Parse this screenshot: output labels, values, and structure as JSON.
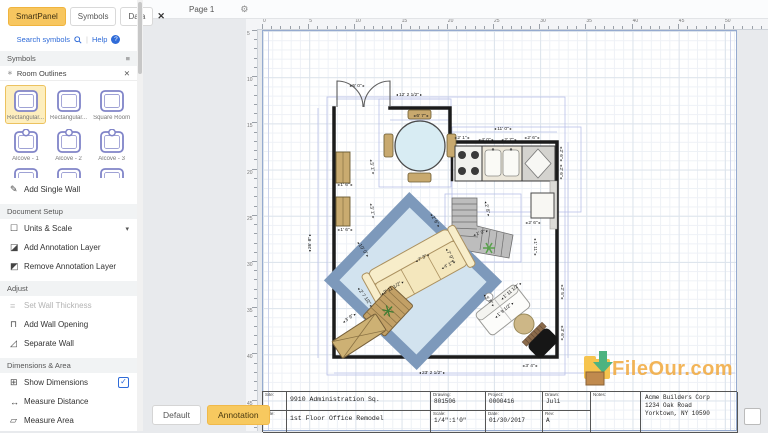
{
  "sidebar": {
    "tabs": [
      {
        "label": "SmartPanel",
        "active": true
      },
      {
        "label": "Symbols",
        "active": false
      },
      {
        "label": "Data",
        "active": false
      }
    ],
    "close_icon": "✕",
    "search": {
      "label": "Search symbols",
      "help": "Help"
    },
    "panel_header": "Symbols",
    "group_header": "Room Outlines",
    "symbols": [
      {
        "label": "Rectangular...",
        "selected": true
      },
      {
        "label": "Rectangular...",
        "selected": false
      },
      {
        "label": "Square Room",
        "selected": false
      },
      {
        "label": "Alcove - 1",
        "selected": false
      },
      {
        "label": "Alcove - 2",
        "selected": false
      },
      {
        "label": "Alcove - 3",
        "selected": false
      }
    ],
    "sections": [
      {
        "title": null,
        "items": [
          {
            "label": "Add Single Wall",
            "icon": "pencil"
          }
        ]
      },
      {
        "title": "Document Setup",
        "items": [
          {
            "label": "Units & Scale",
            "icon": "units",
            "chevron": true
          },
          {
            "label": "Add Annotation Layer",
            "icon": "add-layer"
          },
          {
            "label": "Remove Annotation Layer",
            "icon": "remove-layer"
          }
        ]
      },
      {
        "title": "Adjust",
        "items": [
          {
            "label": "Set Wall Thickness",
            "icon": "thickness",
            "disabled": true
          },
          {
            "label": "Add Wall Opening",
            "icon": "opening"
          },
          {
            "label": "Separate Wall",
            "icon": "separate"
          }
        ]
      },
      {
        "title": "Dimensions & Area",
        "items": [
          {
            "label": "Show Dimensions",
            "icon": "dimensions",
            "checked": true
          },
          {
            "label": "Measure Distance",
            "icon": "distance"
          },
          {
            "label": "Measure Area",
            "icon": "area"
          }
        ]
      }
    ]
  },
  "pagebar": {
    "page_label": "Page 1"
  },
  "rulers": {
    "horizontal": [
      "0",
      "5",
      "10",
      "15",
      "20",
      "25",
      "30",
      "35",
      "40",
      "45",
      "50"
    ],
    "vertical": [
      "5",
      "10",
      "15",
      "20",
      "25",
      "30",
      "35",
      "40",
      "45"
    ]
  },
  "plan": {
    "dimensions": [
      {
        "t": "5' 0\"",
        "x": 357,
        "y": 87,
        "r": 0
      },
      {
        "t": "12' 2 1/2\"",
        "x": 409,
        "y": 96,
        "r": 0
      },
      {
        "t": "6' 7\"",
        "x": 421,
        "y": 117,
        "r": 0
      },
      {
        "t": "11' 0\"",
        "x": 503,
        "y": 130,
        "r": 0
      },
      {
        "t": "2' 1\"",
        "x": 462,
        "y": 139,
        "r": 0
      },
      {
        "t": "4' 0\"",
        "x": 486,
        "y": 141,
        "r": 0
      },
      {
        "t": "2' 7\"",
        "x": 509,
        "y": 141,
        "r": 0
      },
      {
        "t": "2' 6\"",
        "x": 532,
        "y": 139,
        "r": 0
      },
      {
        "t": "2' 6\"",
        "x": 560,
        "y": 154,
        "r": 90
      },
      {
        "t": "2' 6\"",
        "x": 560,
        "y": 172,
        "r": 90
      },
      {
        "t": "2' 8\"",
        "x": 486,
        "y": 209,
        "r": 78
      },
      {
        "t": "2' 6\"",
        "x": 434,
        "y": 221,
        "r": 58
      },
      {
        "t": "1' 0\"",
        "x": 481,
        "y": 234,
        "r": -18
      },
      {
        "t": "4' 1\"",
        "x": 449,
        "y": 266,
        "r": -28
      },
      {
        "t": "1' 11\"",
        "x": 534,
        "y": 247,
        "r": 90
      },
      {
        "t": "2' 6\"",
        "x": 533,
        "y": 224,
        "r": 0
      },
      {
        "t": "7' 3\"",
        "x": 423,
        "y": 259,
        "r": -28
      },
      {
        "t": "7' 9\"",
        "x": 449,
        "y": 256,
        "r": 62
      },
      {
        "t": "10' 0\"",
        "x": 362,
        "y": 250,
        "r": 55
      },
      {
        "t": "2' 11 1/2\"",
        "x": 393,
        "y": 289,
        "r": -30
      },
      {
        "t": "2' 7 1/2\"",
        "x": 364,
        "y": 298,
        "r": 55
      },
      {
        "t": "3' 1\"",
        "x": 371,
        "y": 167,
        "r": 80
      },
      {
        "t": "1' 6\"",
        "x": 345,
        "y": 186,
        "r": 0
      },
      {
        "t": "3' 1\"",
        "x": 371,
        "y": 211,
        "r": 80
      },
      {
        "t": "1' 6\"",
        "x": 345,
        "y": 231,
        "r": 0
      },
      {
        "t": "3' 9\"",
        "x": 350,
        "y": 319,
        "r": -35
      },
      {
        "t": "3' 9\"",
        "x": 488,
        "y": 301,
        "r": 50
      },
      {
        "t": "1' 11 1/2\"",
        "x": 512,
        "y": 292,
        "r": -40
      },
      {
        "t": "1' 9 1/2\"",
        "x": 505,
        "y": 311,
        "r": -40
      },
      {
        "t": "2' 5\"",
        "x": 561,
        "y": 292,
        "r": 90
      },
      {
        "t": "3' 6\"",
        "x": 561,
        "y": 333,
        "r": 90
      },
      {
        "t": "3' 4\"",
        "x": 530,
        "y": 367,
        "r": 0
      },
      {
        "t": "23' 2 1/2\"",
        "x": 432,
        "y": 374,
        "r": 0
      },
      {
        "t": "26' 8\"",
        "x": 311,
        "y": 243,
        "r": -90
      }
    ]
  },
  "title_block": {
    "site_label": "Site:",
    "site": "9910 Administration Sq.",
    "title_label": "Title:",
    "title": "1st Floor Office Remodel",
    "drawing_label": "Drawing:",
    "drawing": "801506",
    "project_label": "Project:",
    "project": "0000416",
    "drawn_label": "Drawn:",
    "drawn": "Juli",
    "scale_label": "Scale:",
    "scale": "1/4\":1'0\"",
    "date_label": "Date:",
    "date": "01/30/2017",
    "rev_label": "Rev:",
    "rev": "A",
    "notes_label": "Notes:",
    "company": [
      "Acme Builders Corp",
      "1234 Oak Road",
      "Yorktown, NY 10590"
    ]
  },
  "footer": {
    "buttons": [
      {
        "label": "Default",
        "active": false
      },
      {
        "label": "Annotation",
        "active": true
      }
    ]
  },
  "watermark": "FileOur.com",
  "colors": {
    "accent_yellow": "#f7c65f",
    "symbol_purple": "#8084c8",
    "link_blue": "#2f6bd8",
    "wall": "#1b1b1b",
    "rug_border": "#7d99bb",
    "rug_fill": "#d2e3ef",
    "wood": "#c9ab70",
    "watermark_orange": "#f2a93b"
  }
}
